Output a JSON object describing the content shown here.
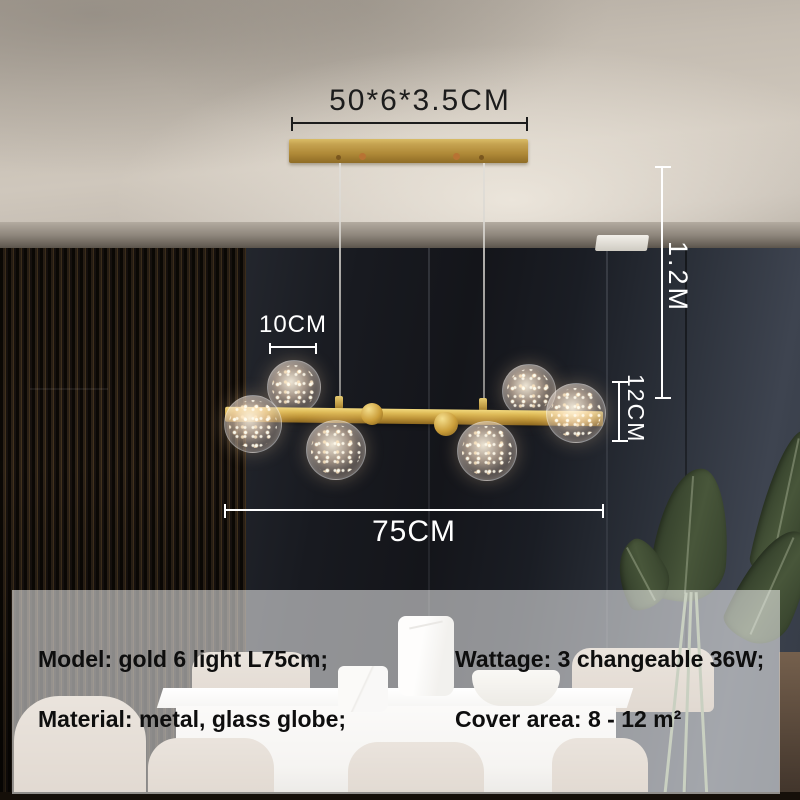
{
  "annotations": {
    "canopy_size": "50*6*3.5CM",
    "small_globe_diameter": "10CM",
    "bar_length": "75CM",
    "drop_height": "1.2M",
    "large_globe_diameter": "12CM"
  },
  "specs": {
    "model": "Model: gold 6 light L75cm;",
    "material": "Material: metal, glass globe;",
    "wattage": "Wattage: 3 changeable 36W;",
    "cover_area": "Cover area: 8 - 12 m²"
  },
  "product": {
    "globe_count": 6,
    "cord_count": 2
  },
  "colors": {
    "gold_accent": "#c9a34a",
    "wall_dark": "#1a1d24",
    "annotation_white": "#ffffff",
    "annotation_dark": "#1c1c1c",
    "spec_text": "#0e0e0e",
    "overlay": "rgba(255,255,255,0.53)"
  }
}
